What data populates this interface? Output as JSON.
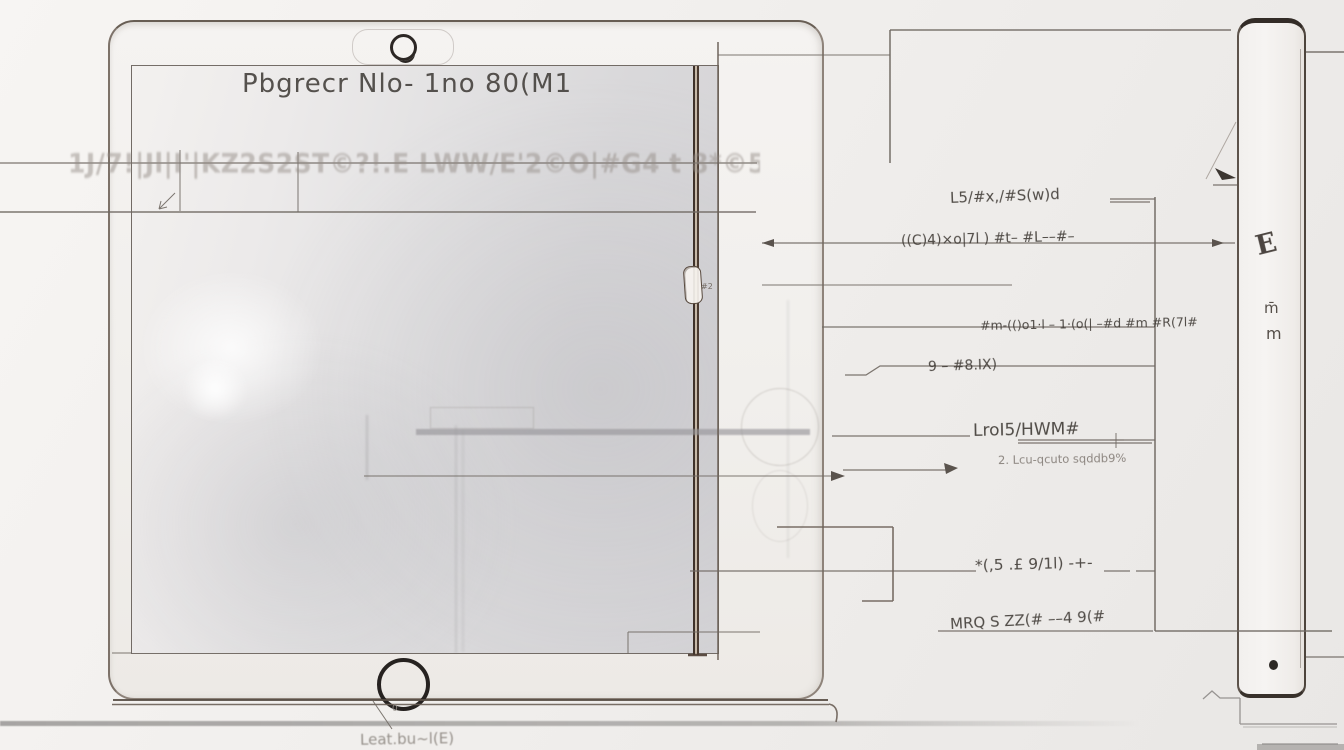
{
  "drawing": {
    "title": "Pbgrecr Nlo- 1no 80(M1",
    "watermark_text": "1J/7!|Jl|I'|KZ2S2ST©?!.E LWW/E'2©O|#G4 t 8*©5tCO",
    "bottom_note": "Leat.bu~l(E)",
    "bottom_note_mark": "0",
    "clip_mark": "#2"
  },
  "callouts": [
    {
      "label": "L5/#x,/#S(w)d"
    },
    {
      "label": "((C)4)×o|7l ) #t– #L––#–"
    },
    {
      "label": "#m-(()o1·l – 1·(o(| –#d #m #R(7l#"
    },
    {
      "label": "9 – #8.IX)"
    },
    {
      "label": "LroI5/HWM#",
      "sub": "2. Lcu-qcuto sqddb9%"
    },
    {
      "label": "*(,5 .£ 9/1l) -+-"
    },
    {
      "label": "MRQ S ZZ(# ––4 9(#"
    }
  ],
  "side_view": {
    "marks": [
      "E",
      "m̄",
      "m"
    ]
  },
  "colors": {
    "construction_line": "#6f6862",
    "dark_flex_line": "#4a3b31",
    "ink": "#3f3a35",
    "faded_ink": "#8d8781",
    "table_edge": "#b3b1af",
    "background": "#f2f0ee"
  }
}
